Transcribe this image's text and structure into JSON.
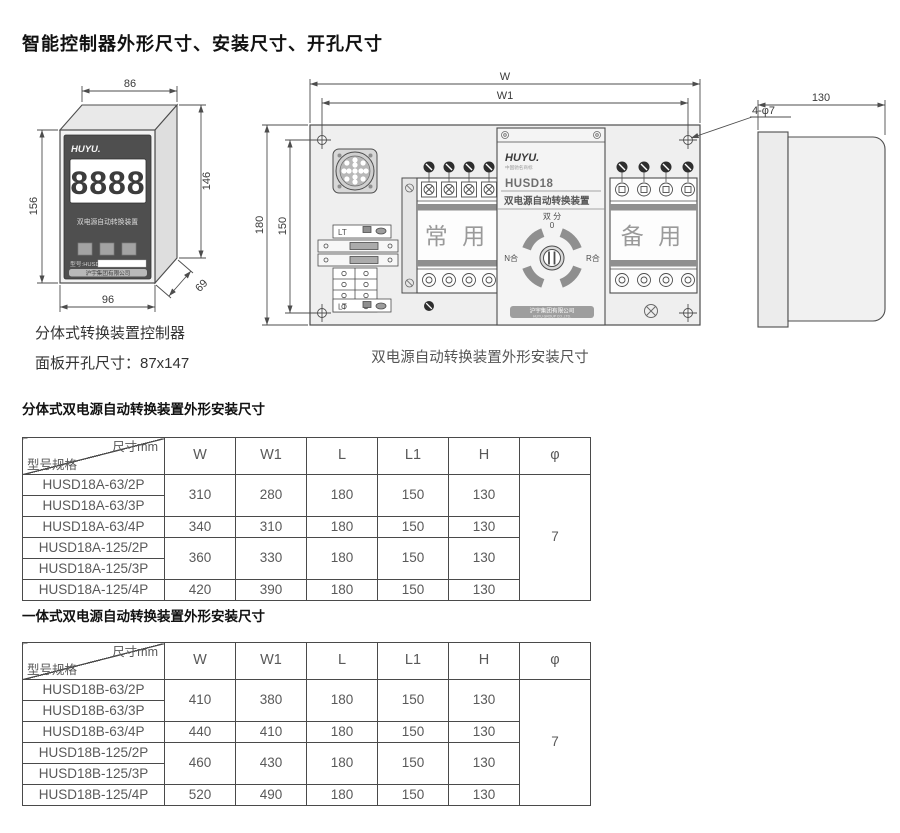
{
  "page": {
    "title": "智能控制器外形尺寸、安装尺寸、开孔尺寸"
  },
  "controller": {
    "dim_top": "86",
    "dim_left": "156",
    "dim_right": "146",
    "dim_bottom": "96",
    "dim_depth": "69",
    "brand": "HUYU.",
    "display": "8888",
    "device_label": "双电源自动转换装置",
    "model_label": "型号:HUSD",
    "company": "沪宇集团有限公司",
    "caption": "分体式转换装置控制器",
    "cutout": "面板开孔尺寸：87x147"
  },
  "ats": {
    "dim_w": "W",
    "dim_w1": "W1",
    "dim_h": "180",
    "dim_h1": "150",
    "holes_label": "4-φ7",
    "dim_depth": "130",
    "brand": "HUYU.",
    "brand_sub": "中国驰名商标",
    "model": "HUSD18",
    "device_name": "双电源自动转换装置",
    "normal_label": "常 用",
    "backup_label": "备 用",
    "sw_top": "双 分",
    "sw_zero": "0",
    "sw_left": "N合",
    "sw_right": "R合",
    "lt_top": "LT",
    "lt_bottom": "LT",
    "company": "沪宇集团有限公司",
    "company_en": "HUYU GROUP CO.,LTD.",
    "caption": "双电源自动转换装置外形安装尺寸"
  },
  "section1": {
    "heading": "分体式双电源自动转换装置外形安装尺寸"
  },
  "section2": {
    "heading": "一体式双电源自动转换装置外形安装尺寸"
  },
  "table_header": {
    "corner_top": "尺寸mm",
    "corner_bottom": "型号规格",
    "columns": [
      "W",
      "W1",
      "L",
      "L1",
      "H",
      "φ"
    ]
  },
  "table1": {
    "phi": "7",
    "rows": [
      {
        "model": "HUSD18A-63/2P",
        "values": [
          "310",
          "280",
          "180",
          "150",
          "130"
        ]
      },
      {
        "model": "HUSD18A-63/3P"
      },
      {
        "model": "HUSD18A-63/4P",
        "values": [
          "340",
          "310",
          "180",
          "150",
          "130"
        ]
      },
      {
        "model": "HUSD18A-125/2P",
        "values": [
          "360",
          "330",
          "180",
          "150",
          "130"
        ]
      },
      {
        "model": "HUSD18A-125/3P"
      },
      {
        "model": "HUSD18A-125/4P",
        "values": [
          "420",
          "390",
          "180",
          "150",
          "130"
        ]
      }
    ]
  },
  "table2": {
    "phi": "7",
    "rows": [
      {
        "model": "HUSD18B-63/2P",
        "values": [
          "410",
          "380",
          "180",
          "150",
          "130"
        ]
      },
      {
        "model": "HUSD18B-63/3P"
      },
      {
        "model": "HUSD18B-63/4P",
        "values": [
          "440",
          "410",
          "180",
          "150",
          "130"
        ]
      },
      {
        "model": "HUSD18B-125/2P",
        "values": [
          "460",
          "430",
          "180",
          "150",
          "130"
        ]
      },
      {
        "model": "HUSD18B-125/3P"
      },
      {
        "model": "HUSD18B-125/4P",
        "values": [
          "520",
          "490",
          "180",
          "150",
          "130"
        ]
      }
    ]
  }
}
